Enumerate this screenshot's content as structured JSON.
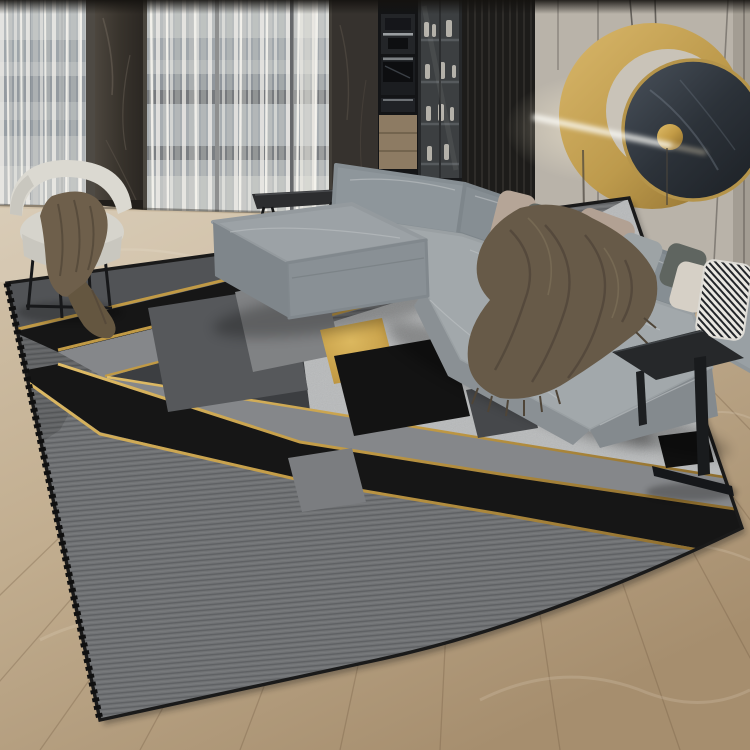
{
  "scene": {
    "title": "Modern living room with geometric gray and gold area rug",
    "setting": "interior product photograph, no visible text",
    "objects": [
      {
        "name": "area-rug",
        "description": "large gray rug with black and gold diagonal bands, chevron corner and geometric squares in gray, black and gold"
      },
      {
        "name": "sectional-sofa",
        "description": "gray L-shaped sectional sofa with throw pillows and a brown fringed throw blanket"
      },
      {
        "name": "barrel-chair",
        "description": "cream curved barrel armchair with dark brown throw draped over it"
      },
      {
        "name": "coffee-bench",
        "description": "low dark slim-leg bench behind the ottoman"
      },
      {
        "name": "side-table",
        "description": "black C-shaped metal side table beside the chaise"
      },
      {
        "name": "wall-art",
        "description": "round gold ring sculpture with dark marble disc and glowing LED light bar"
      },
      {
        "name": "windows",
        "description": "floor-to-ceiling windows with sheer curtains and a city view"
      },
      {
        "name": "kitchen-wall",
        "description": "dark built-in cabinetry with coffee machine, ovens and glass display case"
      },
      {
        "name": "wood-floor",
        "description": "light oak plank flooring"
      }
    ],
    "colors": {
      "rug_outer_gray": "#727476",
      "rug_light_gray": "#b8babb",
      "rug_band_gray": "#85878a",
      "rug_margin_gray": "#515356",
      "rug_dark_gray": "#3c3e41",
      "rug_black": "#161616",
      "gold": "#c7a04c",
      "sofa_gray": "#a2a8ab",
      "sofa_front_gray": "#8a9094",
      "blanket_brown": "#675a48",
      "chair_cream": "#dbd9d1",
      "wall_beige": "#b9b3a9",
      "panel_dark": "#1d1c1a",
      "marble_dark": "#36322e",
      "wood_light": "#c6b49c",
      "mirror_marble": "#2e343b",
      "light_bar": "#fdfdf8"
    }
  }
}
